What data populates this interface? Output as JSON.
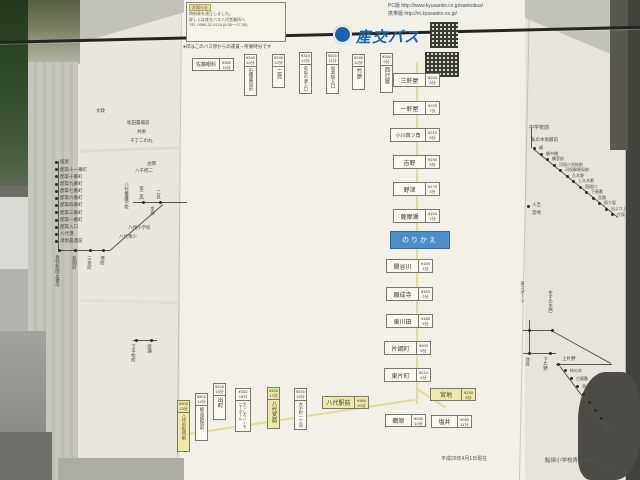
{
  "header": {
    "brand": "産交バス",
    "pc_label": "PC版",
    "pc_url": "http://www.kyusanko.co.jp/sankobus/",
    "mobile_label": "携帯版",
    "mobile_url": "http://m.kyusanko.co.jp/",
    "top_note": "●印はこのバス停からの運賃・所要時分です",
    "notice": {
      "tag": "お知らせ",
      "line1": "時刻表を改正しました。",
      "line2": "詳しくは産交バス八代営業所へ",
      "line3": "TEL 0965-32-9116 (8:30～17:30)"
    },
    "colors": {
      "brand_blue": "#1565b0",
      "current_blue": "#4a8fc7",
      "highlight_yellow": "#efe9a6"
    }
  },
  "left_route": {
    "stops": [
      "塩屋",
      "郡築十一番町",
      "郡築十番町",
      "郡築九番町",
      "郡築七番町",
      "郡築六番町",
      "郡築四番町",
      "郡築三番町",
      "郡築一番町",
      "郡築入口",
      "八代港",
      "須恵農連前"
    ],
    "branch_stops": [
      "貨物税関支署前",
      "新開町",
      "三条町",
      "港町"
    ],
    "junction": {
      "school": "八代養護学校",
      "stop1": "第二高",
      "stop2": "二見",
      "dest": "水俣",
      "label1": "八代小学校",
      "label2": "八代青少"
    },
    "west_stops": [
      "下平松町",
      "渡瀬"
    ],
    "area_labels": [
      "文政",
      "松田農場前",
      "共栄",
      "千丁二の丸",
      "古閑",
      "八千把二"
    ]
  },
  "main_column": {
    "top_row": [
      {
        "name": "佐藤眼科",
        "fare": "¥360",
        "time": "15分"
      },
      {
        "name": "石橋薬局前",
        "fare": "¥340",
        "time": "14分"
      },
      {
        "name": "二見",
        "fare": "¥330",
        "time": "13分"
      },
      {
        "name": "名坂の渡入口",
        "fare": "¥310",
        "time": "12分"
      },
      {
        "name": "坂本駅入口",
        "fare": "¥300",
        "time": "11分"
      },
      {
        "name": "竹原",
        "fare": "¥280",
        "time": "10分"
      },
      {
        "name": "西行屋",
        "fare": "¥260",
        "time": "9分"
      }
    ],
    "stops_upper": [
      {
        "name": "三軒屋",
        "fare": "¥240",
        "time": "8分"
      },
      {
        "name": "一軒屋",
        "fare": "¥220",
        "time": "7分"
      },
      {
        "name": "小川四ツ角",
        "fare": "¥210",
        "time": "6分"
      },
      {
        "name": "吉野",
        "fare": "¥190",
        "time": "5分"
      },
      {
        "name": "野津",
        "fare": "¥170",
        "time": "3分"
      },
      {
        "name": "薩摩瀬",
        "fare": "¥150",
        "time": "2分"
      }
    ],
    "current": {
      "label": "のりかえ"
    },
    "stops_lower": [
      {
        "name": "関谷川",
        "fare": "¥150",
        "time": "1分"
      },
      {
        "name": "願成寺",
        "fare": "¥160",
        "time": "2分"
      },
      {
        "name": "東川田",
        "fare": "¥180",
        "time": "4分"
      },
      {
        "name": "片鋼町",
        "fare": "¥200",
        "time": "5分"
      },
      {
        "name": "東片町",
        "fare": "¥210",
        "time": "6分"
      },
      {
        "name": "宮地",
        "fare": "¥240",
        "time": "8分"
      },
      {
        "name": "鶴原",
        "fare": "¥260",
        "time": "10分"
      },
      {
        "name": "塩井",
        "fare": "¥280",
        "time": "11分"
      }
    ],
    "bottom_row": [
      {
        "name": "八代市役所前",
        "fare": "¥300",
        "time": "13分"
      },
      {
        "name": "総合病院前",
        "fare": "¥300",
        "time": "14分"
      },
      {
        "name": "出町",
        "fare": "¥320",
        "time": "15分"
      },
      {
        "name": "やつしろハーモニーホール",
        "fare": "¥330",
        "time": "16分"
      },
      {
        "name": "八代宮前",
        "fare": "¥330",
        "time": "17分"
      },
      {
        "name": "大手町一丁目",
        "fare": "¥340",
        "time": "18分"
      },
      {
        "name": "八代駅前",
        "fare": "¥360",
        "time": "20分"
      }
    ]
  },
  "right_routes": {
    "upper": {
      "label1": "中学校前",
      "label2": "私の木地蔵前",
      "stops": [
        "鶴",
        "鶴中橋",
        "鶴宮前",
        "河俣小学校前",
        "河俣郵便局前",
        "久木野",
        "上久木野",
        "国道口",
        "下屋敷",
        "宮路",
        "振り坂",
        "出より上",
        "片俣"
      ],
      "dest1": "人吉",
      "dest2": "宮崎"
    },
    "lower": {
      "label_sports": "泉スポーツ",
      "label_yusu": "ゆすの木西",
      "label_ike": "池谷",
      "shimo": "下片野",
      "kami": "上片野",
      "stops": [
        "柿の木",
        "古屋敷",
        "草水",
        "日田地",
        "柊入",
        "大平",
        "南川内"
      ]
    }
  },
  "footer": {
    "date": "平成29年4月1日現在",
    "school": "鮎帰小学校青少分校",
    "extra": "川岳"
  }
}
